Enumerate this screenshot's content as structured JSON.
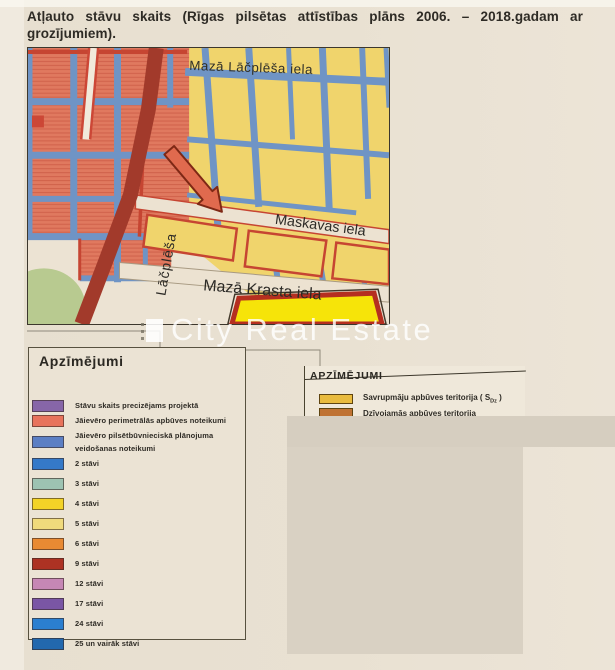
{
  "page": {
    "title": "Atļauto stāvu skaits (Rīgas pilsētas attīstības plāns 2006. – 2018.gadam ar grozījumiem).",
    "watermark": "City Real Estate",
    "background_color": "#e8e0d1"
  },
  "map": {
    "street_labels": {
      "top": "Mazā Lāčplēša iela",
      "middle": "Maskavas iela",
      "bottom": "Mazā Krasta iela",
      "vertical": "Lāčplēša"
    },
    "colors": {
      "streets": "#6f94c5",
      "perimeter_blocks": "#e0795f",
      "low_rise_blocks": "#f0d46c",
      "main_road": "#a23a2b",
      "park": "#b8ca90",
      "highlight_arrow": "#e06a4e",
      "bright_parcel": "#f6e409"
    }
  },
  "legend_left": {
    "title": "Apzīmējumi",
    "items": [
      {
        "color": "#8766a8",
        "label": "Stāvu skaits precizējams projektā"
      },
      {
        "color": "#e8735c",
        "label": "Jāievēro perimetrālās apbūves noteikumi"
      },
      {
        "color": "#5c7fc4",
        "label": "Jāievēro pilsētbūvnieciskā plānojuma veidošanas noteikumi"
      },
      {
        "color": "#3579c8",
        "label": "2 stāvi"
      },
      {
        "color": "#9dc3b2",
        "label": "3 stāvi"
      },
      {
        "color": "#f3d327",
        "label": "4 stāvi"
      },
      {
        "color": "#f0da7c",
        "label": "5 stāvi"
      },
      {
        "color": "#e98a33",
        "label": "6 stāvi"
      },
      {
        "color": "#ad3223",
        "label": "9 stāvi"
      },
      {
        "color": "#c687b5",
        "label": "12 stāvi"
      },
      {
        "color": "#7a56a5",
        "label": "17 stāvi"
      },
      {
        "color": "#2b7fd0",
        "label": "24 stāvi"
      },
      {
        "color": "#2268ae",
        "label": "25 un vairāk stāvi"
      }
    ]
  },
  "legend_right": {
    "title": "APZĪMĒJUMI",
    "items": [
      {
        "color": "#e9bb3e",
        "label_pre": "Savrupmāju apbūves teritorija ( S",
        "sub": "Dz",
        "label_post": " )"
      },
      {
        "color": "#bf7233",
        "label": "Dzīvojamās apbūves teritorija"
      }
    ]
  }
}
